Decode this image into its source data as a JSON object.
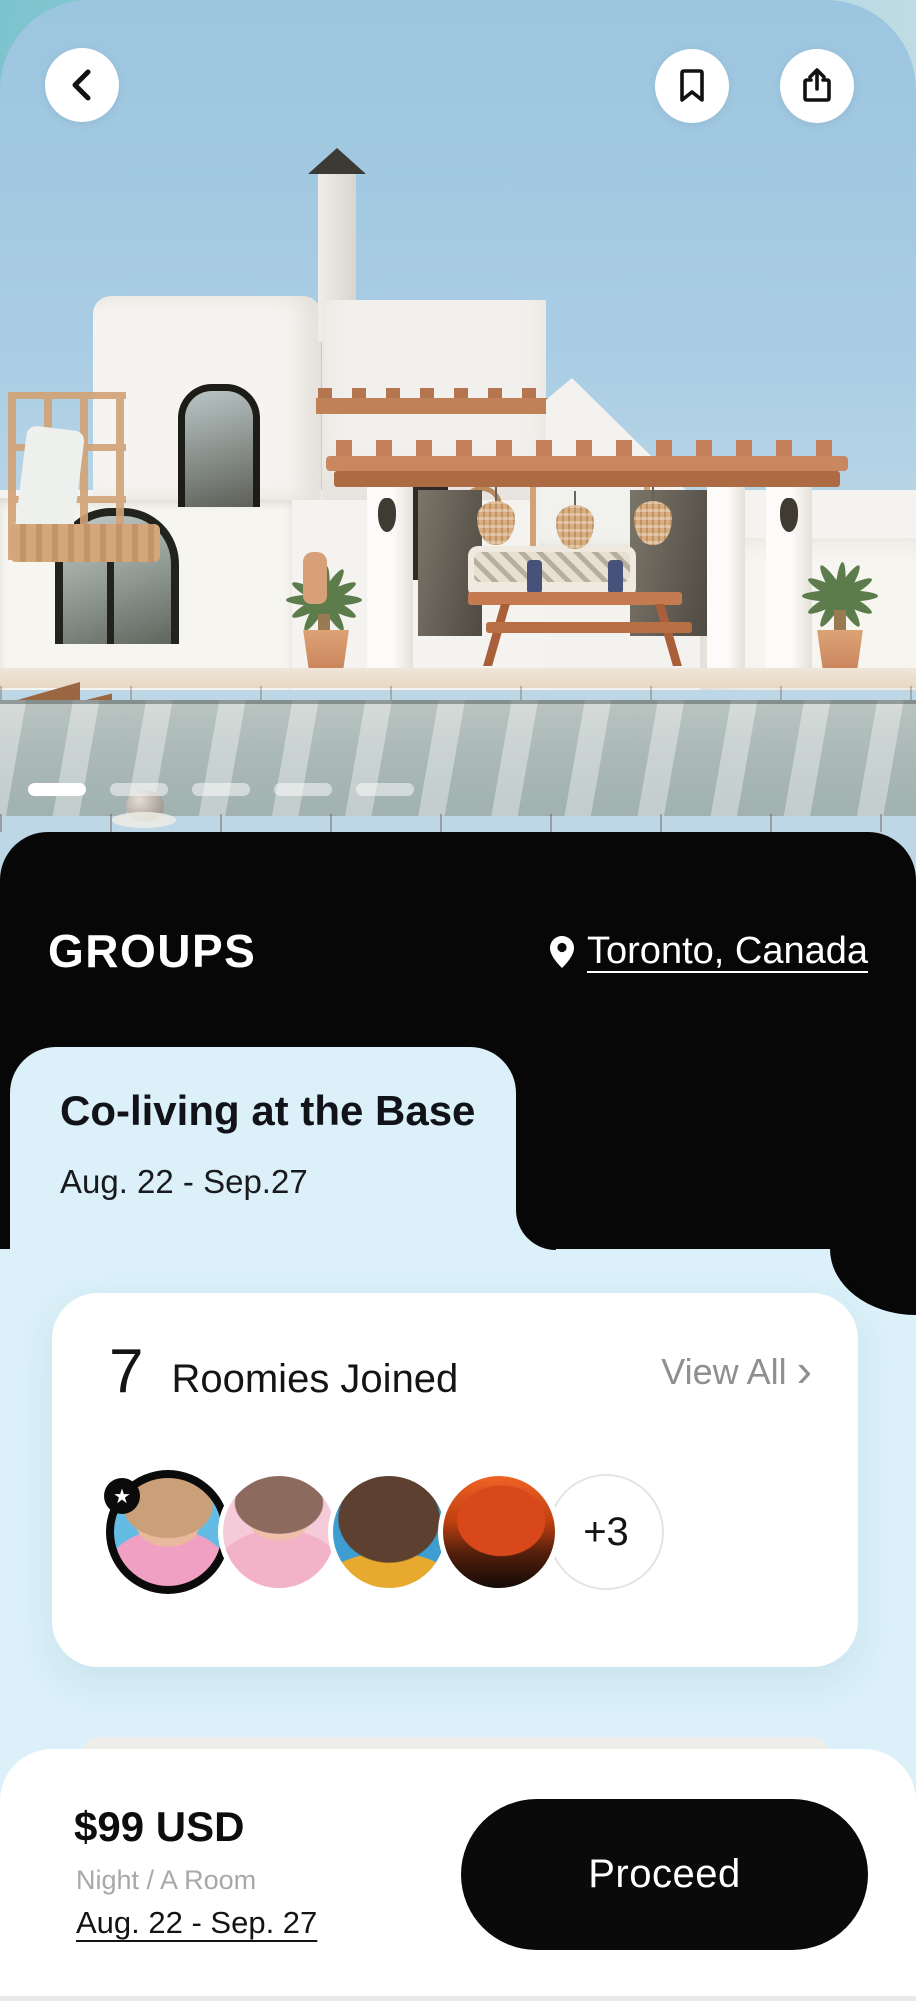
{
  "colors": {
    "panel_black": "#070707",
    "accent_light_blue": "#dbf0f8",
    "card_white": "#ffffff",
    "muted_gray_text": "#8f8f8f",
    "cta_black": "#0a0a0a"
  },
  "nav": {
    "back_icon": "chevron-left",
    "bookmark_icon": "bookmark",
    "share_icon": "share-up-arrow"
  },
  "carousel": {
    "total_pages": 5,
    "active_page": 1
  },
  "header": {
    "title": "GROUPS",
    "location_icon": "map-pin",
    "location": "Toronto, Canada"
  },
  "listing": {
    "title": "Co-living at the Base",
    "date_range": "Aug. 22 - Sep.27"
  },
  "roomies": {
    "count": "7",
    "label": "Roomies Joined",
    "view_all_label": "View All",
    "view_all_chevron": "›",
    "featured_badge": "★",
    "overflow_count": "+3",
    "avatars": [
      {
        "name": "avatar-1",
        "featured": true
      },
      {
        "name": "avatar-2",
        "featured": false
      },
      {
        "name": "avatar-3",
        "featured": false
      },
      {
        "name": "avatar-4",
        "featured": false
      }
    ]
  },
  "booking": {
    "price": "$99 USD",
    "unit": "Night / A Room",
    "date_range": "Aug. 22 - Sep. 27",
    "cta_label": "Proceed"
  }
}
